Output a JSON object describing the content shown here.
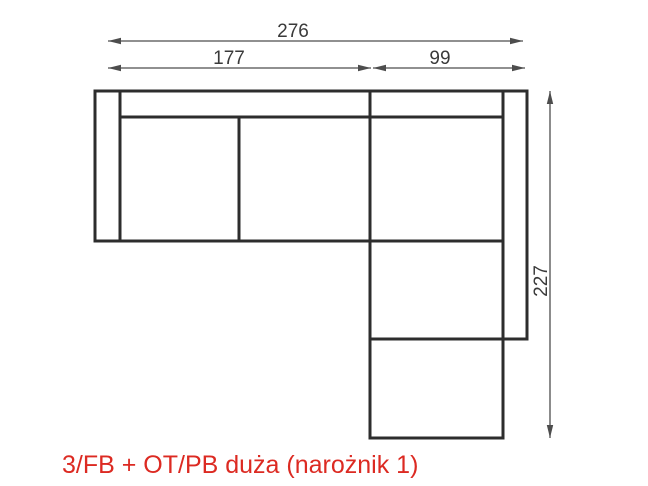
{
  "diagram": {
    "type": "furniture-plan-dimension-drawing",
    "caption": "3/FB + OT/PB duża (narożnik 1)",
    "dimensions": {
      "total_width": "276",
      "left_section_width": "177",
      "right_section_width": "99",
      "total_depth": "227"
    },
    "colors": {
      "outline": "#2d2d2d",
      "dimension_lines": "#4d4d4d",
      "dimension_text": "#3a3a3a",
      "caption_red": "#dc2a22",
      "background": "#ffffff"
    }
  }
}
